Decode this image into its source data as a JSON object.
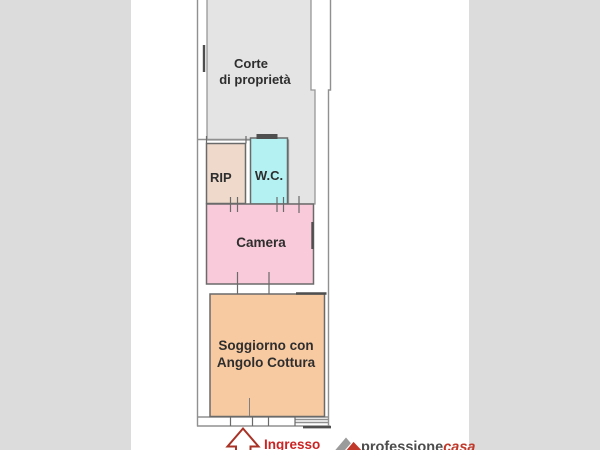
{
  "background": {
    "canvas_color": "#ffffff",
    "side_bar_color": "#dcdcdc"
  },
  "floor_plan": {
    "courtyard": {
      "label_line1": "Corte",
      "label_line2": "di proprietà",
      "color": "#e4e4e4"
    },
    "rooms": {
      "rip": {
        "label": "RIP",
        "color": "#eed9cb"
      },
      "wc": {
        "label": "W.C.",
        "color": "#b3f1f2"
      },
      "camera": {
        "label": "Camera",
        "color": "#f9cada"
      },
      "soggiorno": {
        "label_line1": "Soggiorno con",
        "label_line2": "Angolo Cottura",
        "color": "#f8caa2"
      }
    },
    "entrance": {
      "label": "Ingresso",
      "arrow_color": "#a93226"
    }
  },
  "branding": {
    "logo_text_primary": "professione",
    "logo_text_accent": "casa",
    "primary_color": "#4d4d4d",
    "accent_color": "#c0392b"
  }
}
